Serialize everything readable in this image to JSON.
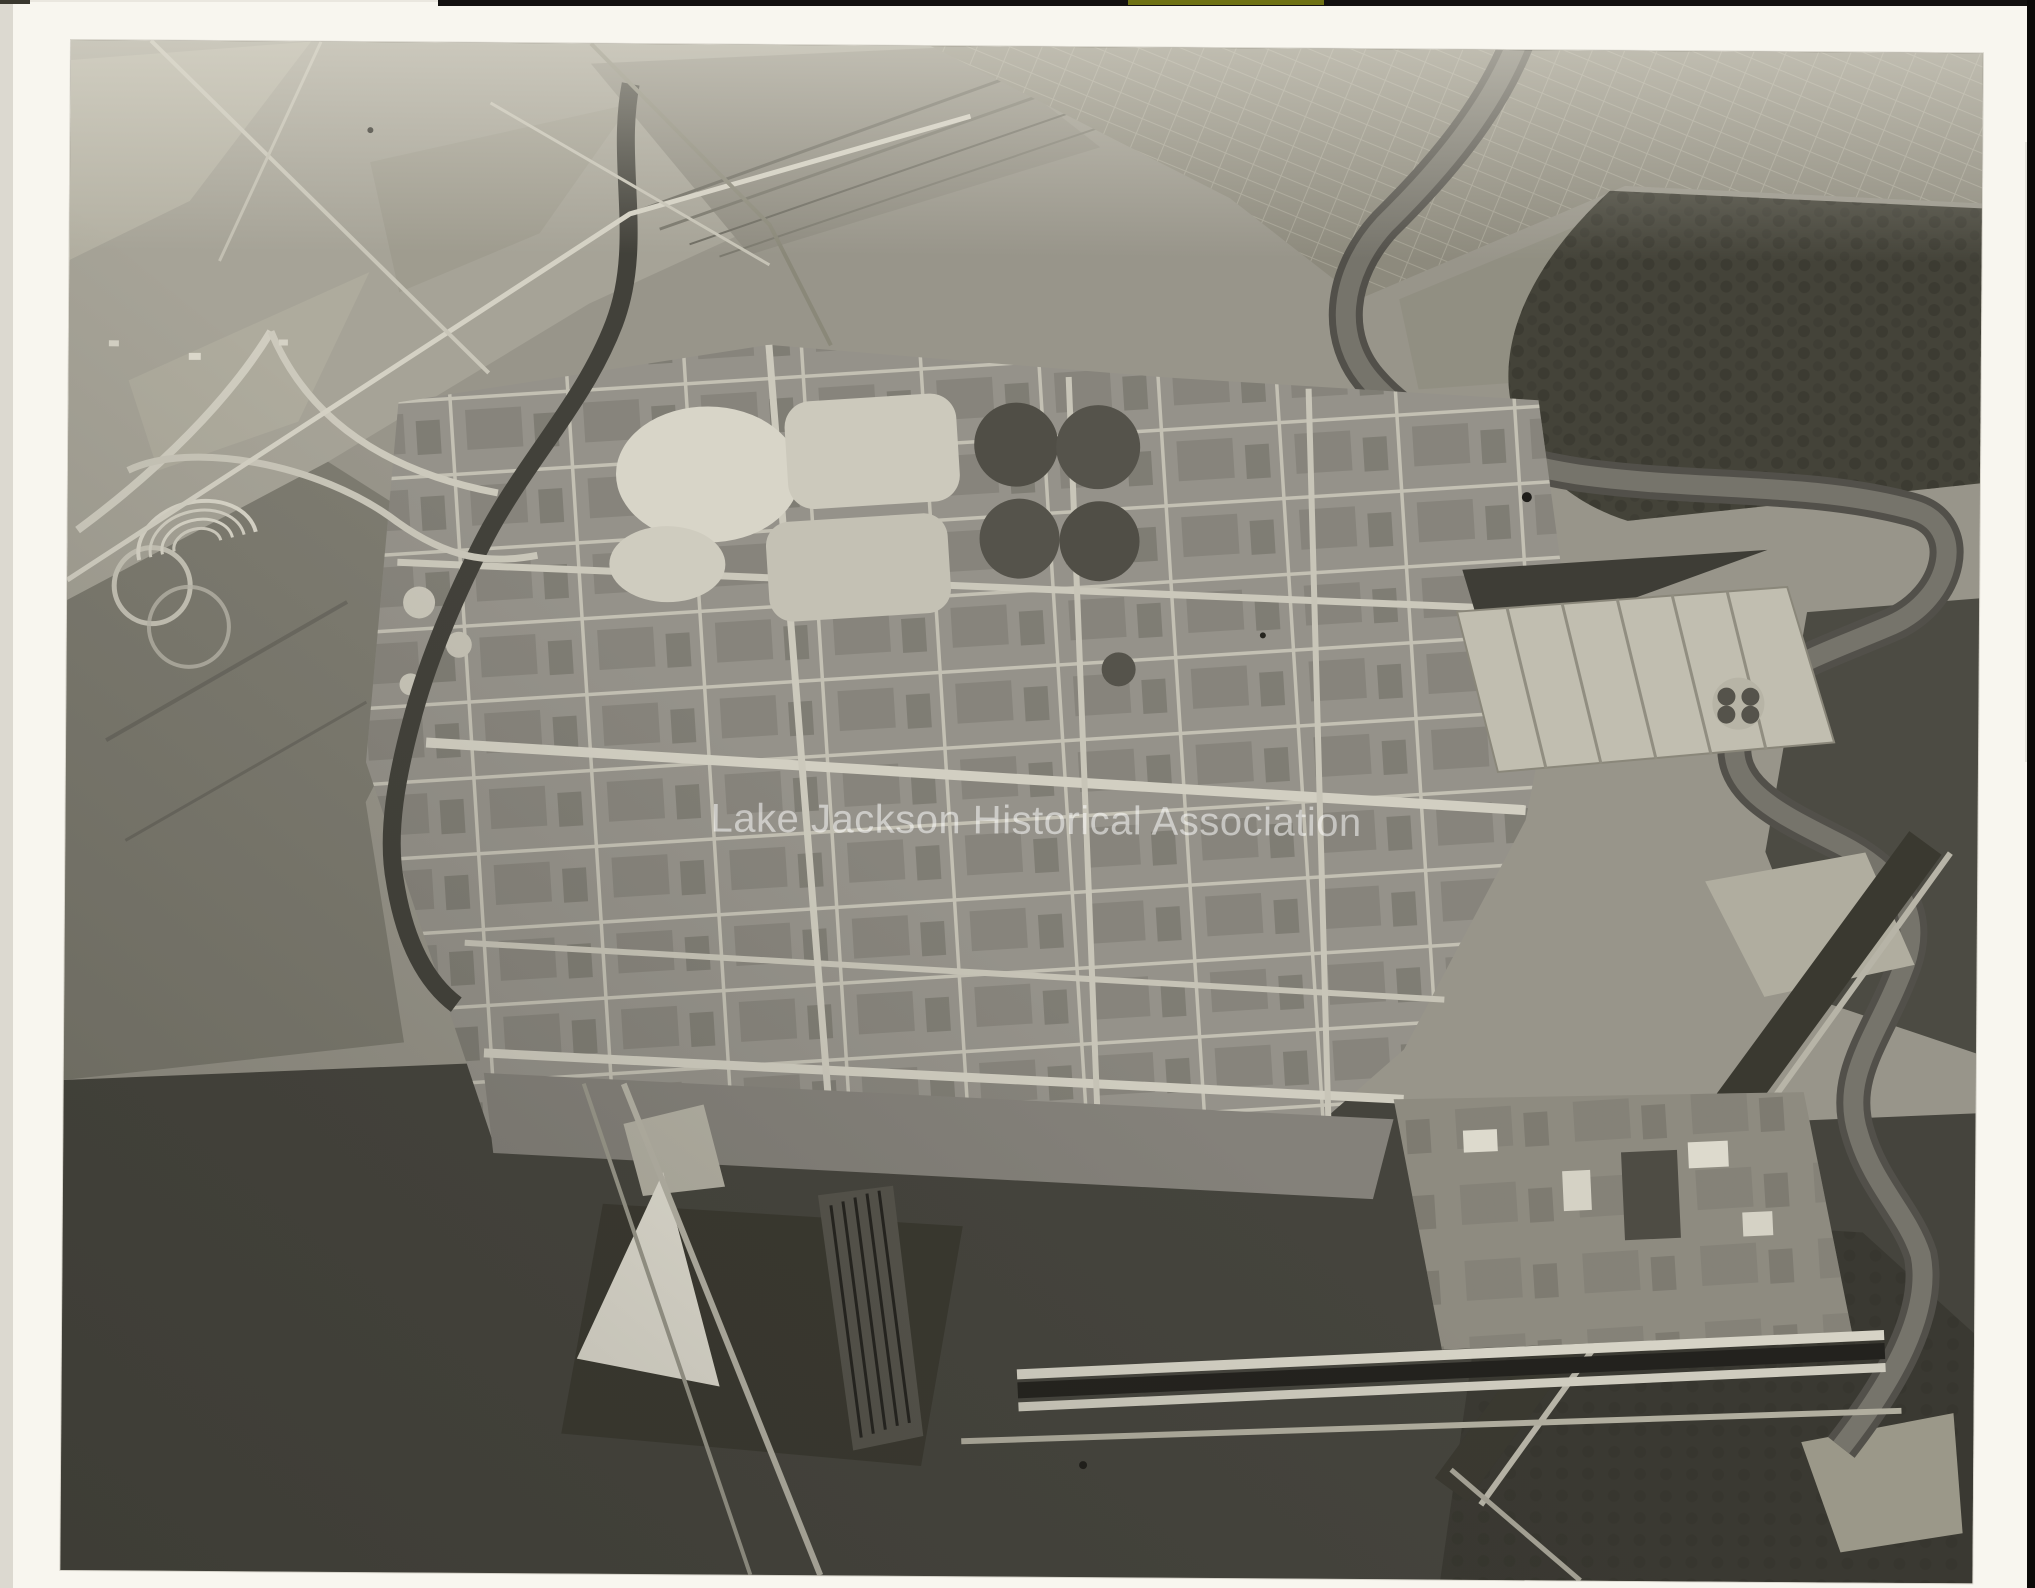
{
  "scan": {
    "watermark": "Lake Jackson Historical Association",
    "description": "Black-and-white aerial photograph of a sprawling riverside chemical plant complex with street grid, settling ponds, rail yards, a highway interchange, a town grid beyond a winding river, and dark woodland along the bottom",
    "colors": {
      "page_background": "#eae7df",
      "print_paper": "#f8f6ef",
      "photo_highlight": "#d6d3c6",
      "photo_midtone": "#98958a",
      "photo_shadow": "#44433b",
      "water_tone": "#76746b",
      "film_edge_black": "#100f0c",
      "film_edge_olive": "#6f7214",
      "watermark_color": "rgba(255,255,255,0.52)"
    }
  }
}
